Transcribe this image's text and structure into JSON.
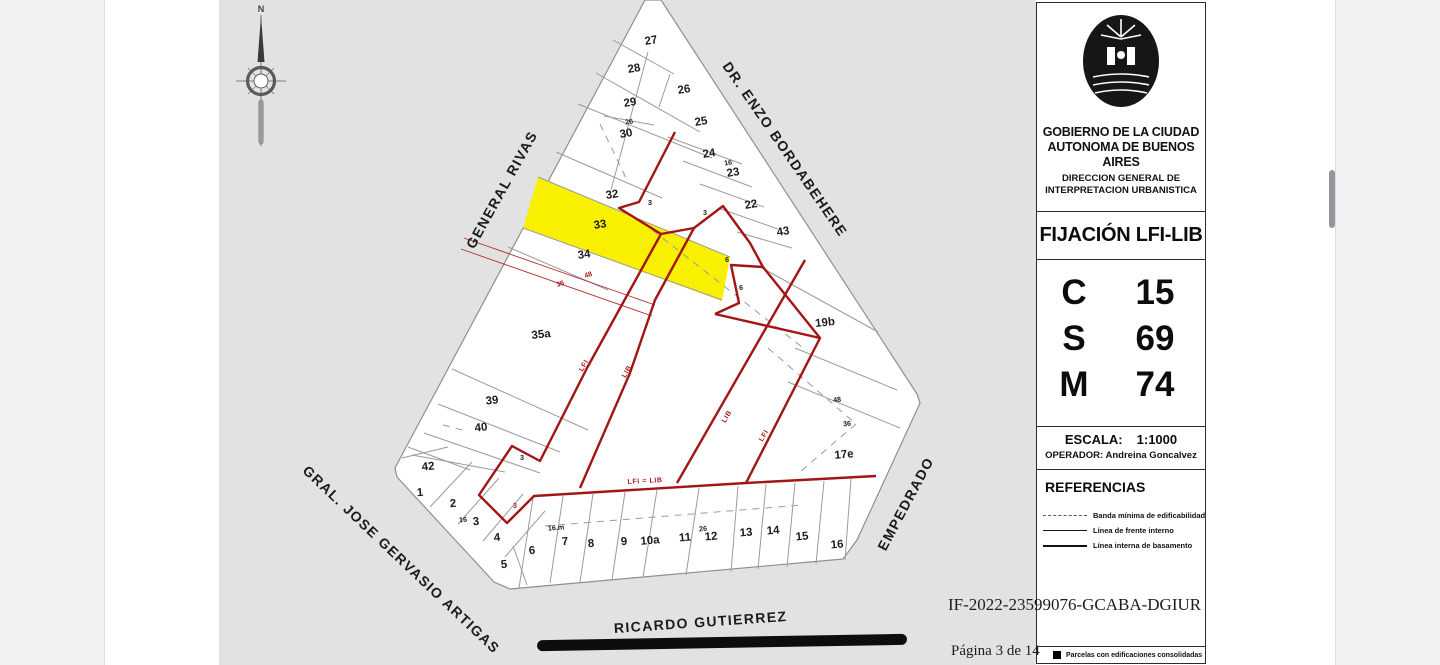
{
  "colors": {
    "accent_red": "#a31515",
    "highlight_yellow": "#f9f000",
    "map_bg": "#e2e2e3",
    "page_bg": "#ffffff",
    "viewer_bg": "#f1f1f4"
  },
  "stamp": {
    "doc_id": "IF-2022-23599076-GCABA-DGIUR",
    "page_indicator": "Página 3 de 14"
  },
  "map": {
    "compass": "N",
    "streets": {
      "upper_left": "GENERAL RIVAS",
      "upper_right": "DR. ENZO BORDABEHERE",
      "right": "EMPEDRADO",
      "lower_left": "GRAL. JOSE GERVASIO ARTIGAS",
      "bottom": "RICARDO GUTIERREZ"
    },
    "lots": {
      "n27": "27",
      "n28": "28",
      "n26": "26",
      "n29": "29",
      "n25": "25",
      "n30": "30",
      "n24": "24",
      "n23": "23",
      "n22": "22",
      "n43": "43",
      "n32": "32",
      "n33": "33",
      "n34": "34",
      "n35a": "35a",
      "n39": "39",
      "n40": "40",
      "n42": "42",
      "n1": "1",
      "n2": "2",
      "n3": "3",
      "n4": "4",
      "n5": "5",
      "n6": "6",
      "n7": "7",
      "n8": "8",
      "n9": "9",
      "n10a": "10a",
      "n11": "11",
      "n12": "12",
      "n13": "13",
      "n14": "14",
      "n15": "15",
      "n16": "16",
      "n17e": "17e",
      "n19b": "19b"
    },
    "dims": {
      "d16": "16",
      "d26": "26",
      "d16m": "16.m",
      "d48": "48",
      "d36": "36",
      "d6": "6",
      "d3": "3"
    },
    "red_annotations": {
      "lfi": "LFI",
      "lib": "LIB",
      "lfi_eq_lib": "LFI = LIB",
      "r36": "36",
      "r48": "48"
    }
  },
  "sidebar": {
    "org_line1": "GOBIERNO DE LA CIUDAD",
    "org_line2": "AUTONOMA DE BUENOS AIRES",
    "org_line3": "DIRECCION GENERAL DE",
    "org_line4": "INTERPRETACION URBANISTICA",
    "title": "FIJACIÓN LFI-LIB",
    "rows": [
      {
        "key": "C",
        "value": "15"
      },
      {
        "key": "S",
        "value": "69"
      },
      {
        "key": "M",
        "value": "74"
      }
    ],
    "scale_label": "ESCALA:",
    "scale_value": "1:1000",
    "operator_label": "OPERADOR:",
    "operator_value": "Andreina Goncalvez",
    "references_title": "REFERENCIAS",
    "legend": [
      {
        "style": "dashed",
        "label": "Banda mínima de edificabilidad"
      },
      {
        "style": "solid-thin",
        "label": "Línea de frente interno"
      },
      {
        "style": "solid-thick",
        "label": "Línea interna de basamento"
      }
    ],
    "footer_legend": "Parcelas con edificaciones consolidadas"
  }
}
